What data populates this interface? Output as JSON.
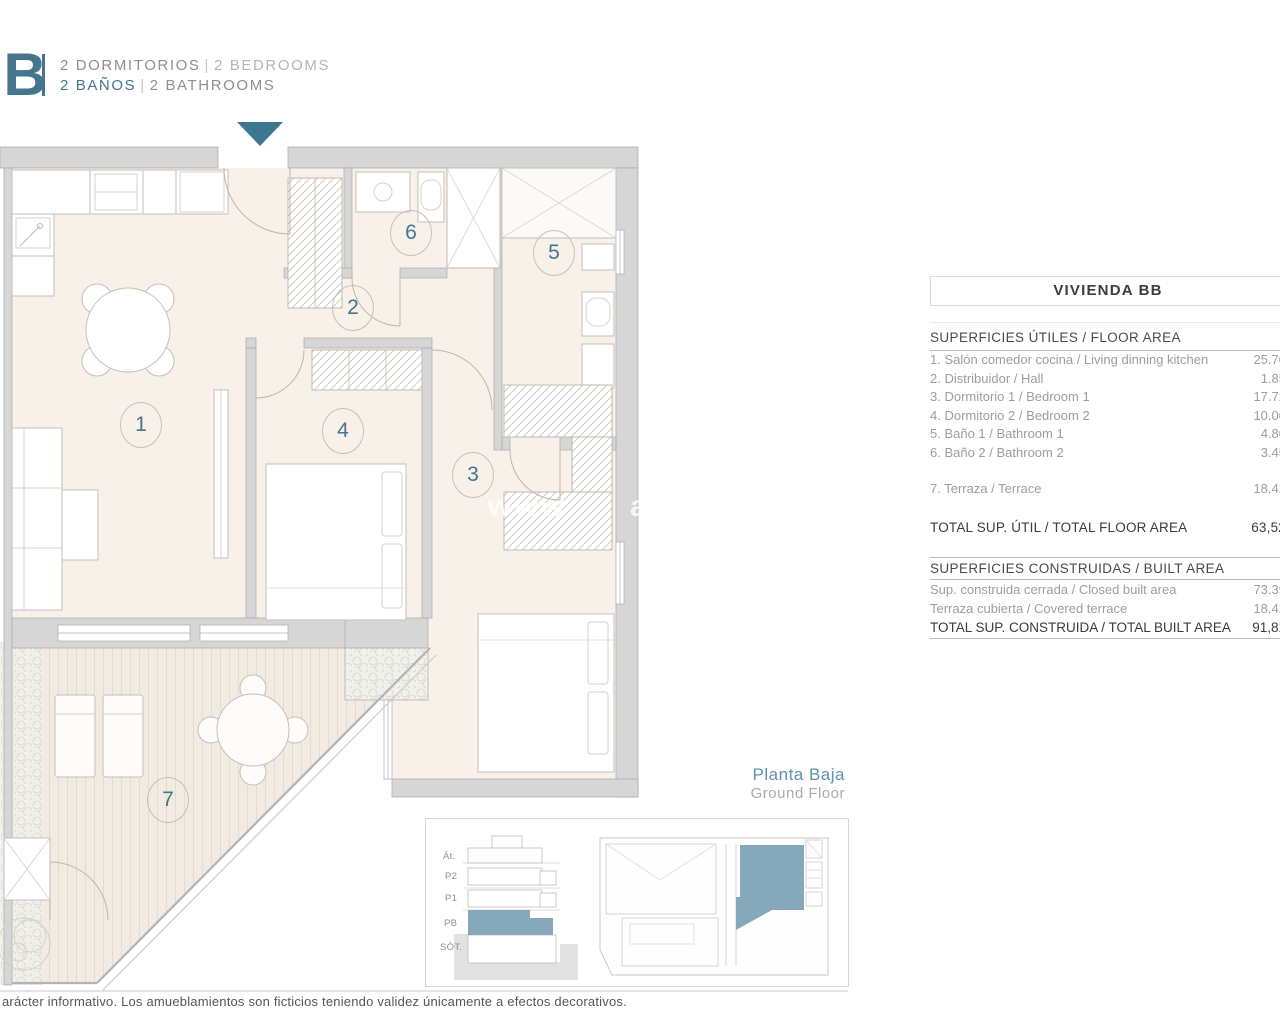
{
  "header": {
    "logo": "BB",
    "line1_left": "2 DORMITORIOS",
    "line1_sep": "|",
    "line1_right": "2 BEDROOMS",
    "line2_left": "2 BAÑOS",
    "line2_sep": "|",
    "line2_right": "2 BATHROOMS"
  },
  "colors": {
    "accent_teal": "#44758d",
    "highlight_teal": "#85a9ba",
    "wall_gray": "#d6d6d6",
    "floor_cream": "#f8f1ea"
  },
  "plan": {
    "rooms": [
      "1",
      "2",
      "3",
      "4",
      "5",
      "6",
      "7"
    ]
  },
  "watermark": {
    "fragments": [
      "www",
      "arp"
    ]
  },
  "panel": {
    "title": "VIVIENDA BB",
    "floor_area": {
      "header": "SUPERFICIES ÚTILES / FLOOR AREA",
      "rows": [
        {
          "label": "1. Salón comedor cocina / Living dinning kitchen",
          "value": "25.70"
        },
        {
          "label": "2. Distribuidor / Hall",
          "value": "1.85"
        },
        {
          "label": "3. Dormitorio 1 / Bedroom 1",
          "value": "17.72"
        },
        {
          "label": "4. Dormitorio 2 / Bedroom 2",
          "value": "10.00"
        },
        {
          "label": "5. Baño 1 / Bathroom 1",
          "value": "4.80"
        },
        {
          "label": "6. Baño 2 / Bathroom 2",
          "value": "3.45"
        }
      ],
      "terrace_row": {
        "label": "7. Terraza / Terrace",
        "value": "18.42"
      },
      "total": {
        "label": "TOTAL SUP. ÚTIL / TOTAL FLOOR AREA",
        "value": "63,52"
      }
    },
    "built_area": {
      "header": "SUPERFICIES CONSTRUIDAS / BUILT AREA",
      "rows": [
        {
          "label": "Sup. construida cerrada / Closed built area",
          "value": "73.39"
        },
        {
          "label": "Terraza cubierta / Covered terrace",
          "value": "18.42"
        }
      ],
      "total": {
        "label": "TOTAL SUP. CONSTRUIDA / TOTAL BUILT AREA",
        "value": "91,81"
      }
    }
  },
  "floor_label": {
    "es": "Planta Baja",
    "en": "Ground Floor"
  },
  "inset": {
    "section_labels": [
      "Át.",
      "P2",
      "P1",
      "PB",
      "SÓT."
    ]
  },
  "footer": {
    "disclaimer": "arácter informativo. Los amueblamientos son ficticios teniendo validez únicamente a efectos decorativos."
  }
}
